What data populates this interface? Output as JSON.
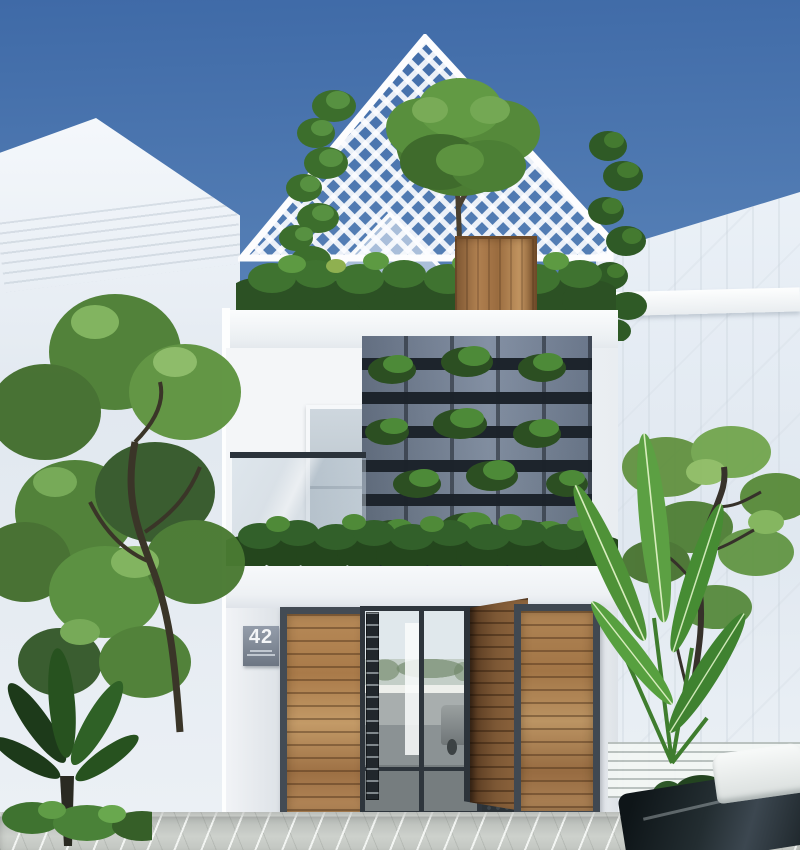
{
  "scene": {
    "type": "exterior-architectural-render",
    "description": "Modern three-storey narrow house with white facade, gabled white lattice roof terrace, slate slatted green-wall screen, wooden entrance gates and a central glass door, flanked by street trees and translucent white neighbour buildings, paved driveway in front",
    "house": {
      "number_plate": {
        "number": "42"
      },
      "levels": [
        {
          "name": "roof-terrace",
          "features": [
            "white lattice gable",
            "tree in tall wooden planter",
            "terrace shrubs",
            "climbing vines"
          ]
        },
        {
          "name": "second-floor",
          "features": [
            "slate slat screen with planted pockets",
            "frosted balcony door",
            "glass balcony railing"
          ]
        },
        {
          "name": "ground-floor",
          "features": [
            "white entrance canopy topped by hedge",
            "wooden swing gates (right leaf open)",
            "central glass door with street reflection",
            "house number plaque",
            "dark mosaic entry tiles"
          ]
        }
      ]
    },
    "surroundings": [
      "large leafy tree on the left",
      "banana plant and airy tree on the right",
      "translucent white neighbour houses",
      "light grey paver driveway",
      "car entering at bottom right"
    ],
    "colors": {
      "sky_top": "#3f6aa7",
      "sky_horizon": "#a9c2dd",
      "facade_white": "#f4f6f8",
      "screen_slate": "#6e7c8e",
      "screen_slot": "#1d242c",
      "wood_light": "#c0935f",
      "wood_mid": "#a97a49",
      "wood_dark": "#7c5531",
      "frame_dark": "#434b54",
      "foliage_dark": "#2c5124",
      "foliage_mid": "#4b7c33",
      "foliage_light": "#6fa84e",
      "hedge_dark": "#24461d",
      "paver_light": "#cdd1cc",
      "paver_dark": "#b7bbb7",
      "plaque_gray": "#6d7683",
      "entry_tile": "#2b3237"
    }
  }
}
